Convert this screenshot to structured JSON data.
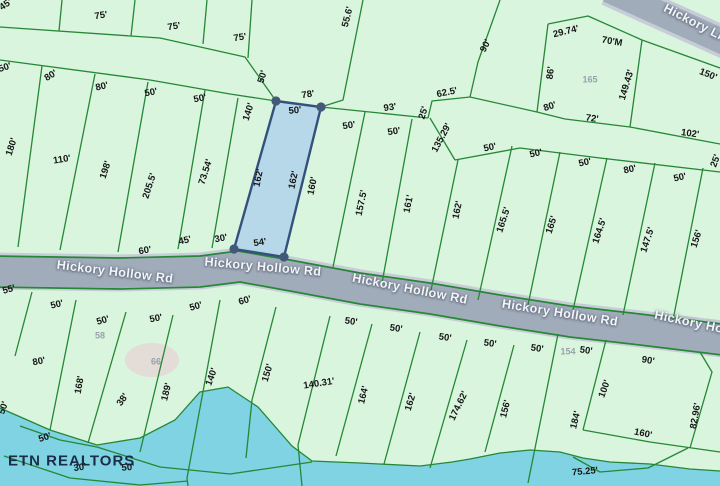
{
  "map": {
    "watermark": "ETN REALTORS",
    "roads": [
      "Hickory Hollow Rd",
      "Hickory Ln"
    ],
    "highlighted_parcel": {
      "fill": "#aed2ec",
      "border": "#33517c"
    },
    "colors": {
      "land": "#d9f5de",
      "lot_line": "#268736",
      "water": "#7fd3e2",
      "road_fill": "#a1acba",
      "road_casing": "#c7cdd7",
      "dimension_text": "#161616",
      "parcel_number_text": "#98a2ab",
      "road_text": "#f3f5f8",
      "watermark_text": "#13203d"
    },
    "labels": [
      {
        "t": "45'",
        "x": 6,
        "y": 5,
        "r": -35,
        "k": "dim"
      },
      {
        "t": "75'",
        "x": 101,
        "y": 16,
        "r": -9,
        "k": "dim"
      },
      {
        "t": "75'",
        "x": 174,
        "y": 27,
        "r": -9,
        "k": "dim"
      },
      {
        "t": "75'",
        "x": 240,
        "y": 38,
        "r": -9,
        "k": "dim"
      },
      {
        "t": "55.6'",
        "x": 348,
        "y": 17,
        "r": -76,
        "k": "dim"
      },
      {
        "t": "90'",
        "x": 486,
        "y": 46,
        "r": -62,
        "k": "dim"
      },
      {
        "t": "29.74'",
        "x": 566,
        "y": 32,
        "r": -14,
        "k": "dim"
      },
      {
        "t": "70'M",
        "x": 612,
        "y": 42,
        "r": 10,
        "k": "dim"
      },
      {
        "t": "86'",
        "x": 551,
        "y": 73,
        "r": -83,
        "k": "dim"
      },
      {
        "t": "165",
        "x": 590,
        "y": 80,
        "r": 0,
        "k": "num"
      },
      {
        "t": "149.43'",
        "x": 627,
        "y": 85,
        "r": -73,
        "k": "dim"
      },
      {
        "t": "150'",
        "x": 708,
        "y": 75,
        "r": 22,
        "k": "dim"
      },
      {
        "t": "80'",
        "x": 550,
        "y": 107,
        "r": -18,
        "k": "dim"
      },
      {
        "t": "72'",
        "x": 592,
        "y": 119,
        "r": 8,
        "k": "dim"
      },
      {
        "t": "102'",
        "x": 690,
        "y": 134,
        "r": 8,
        "k": "dim"
      },
      {
        "t": "25'",
        "x": 716,
        "y": 161,
        "r": -70,
        "k": "dim"
      },
      {
        "t": "50'",
        "x": 5,
        "y": 68,
        "r": -18,
        "k": "dim"
      },
      {
        "t": "80'",
        "x": 51,
        "y": 76,
        "r": -32,
        "k": "dim"
      },
      {
        "t": "80'",
        "x": 102,
        "y": 87,
        "r": -13,
        "k": "dim"
      },
      {
        "t": "50'",
        "x": 151,
        "y": 93,
        "r": -11,
        "k": "dim"
      },
      {
        "t": "50'",
        "x": 200,
        "y": 99,
        "r": -11,
        "k": "dim"
      },
      {
        "t": "50'",
        "x": 263,
        "y": 77,
        "r": -72,
        "k": "dim"
      },
      {
        "t": "140'",
        "x": 249,
        "y": 112,
        "r": -72,
        "k": "dim"
      },
      {
        "t": "78'",
        "x": 308,
        "y": 95,
        "r": -9,
        "k": "dim"
      },
      {
        "t": "50'",
        "x": 295,
        "y": 111,
        "r": -6,
        "k": "dim"
      },
      {
        "t": "93'",
        "x": 390,
        "y": 108,
        "r": -8,
        "k": "dim"
      },
      {
        "t": "62.5'",
        "x": 447,
        "y": 93,
        "r": -11,
        "k": "dim"
      },
      {
        "t": "25'",
        "x": 424,
        "y": 113,
        "r": -72,
        "k": "dim"
      },
      {
        "t": "135.29'",
        "x": 442,
        "y": 138,
        "r": -62,
        "k": "dim"
      },
      {
        "t": "50'",
        "x": 349,
        "y": 126,
        "r": -9,
        "k": "dim"
      },
      {
        "t": "50'",
        "x": 394,
        "y": 132,
        "r": -9,
        "k": "dim"
      },
      {
        "t": "50'",
        "x": 490,
        "y": 148,
        "r": -12,
        "k": "dim"
      },
      {
        "t": "50'",
        "x": 536,
        "y": 154,
        "r": -12,
        "k": "dim"
      },
      {
        "t": "50'",
        "x": 585,
        "y": 163,
        "r": -12,
        "k": "dim"
      },
      {
        "t": "80'",
        "x": 630,
        "y": 170,
        "r": -12,
        "k": "dim"
      },
      {
        "t": "50'",
        "x": 680,
        "y": 178,
        "r": -12,
        "k": "dim"
      },
      {
        "t": "180'",
        "x": 12,
        "y": 147,
        "r": -72,
        "k": "dim"
      },
      {
        "t": "110'",
        "x": 62,
        "y": 160,
        "r": -9,
        "k": "dim"
      },
      {
        "t": "198'",
        "x": 106,
        "y": 170,
        "r": -72,
        "k": "dim"
      },
      {
        "t": "205.5'",
        "x": 150,
        "y": 186,
        "r": -72,
        "k": "dim"
      },
      {
        "t": "73.54'",
        "x": 206,
        "y": 172,
        "r": -72,
        "k": "dim"
      },
      {
        "t": "162'",
        "x": 259,
        "y": 178,
        "r": -78,
        "k": "dim"
      },
      {
        "t": "162'",
        "x": 294,
        "y": 180,
        "r": -78,
        "k": "dim"
      },
      {
        "t": "160'",
        "x": 313,
        "y": 186,
        "r": -78,
        "k": "dim"
      },
      {
        "t": "157.5'",
        "x": 362,
        "y": 203,
        "r": -78,
        "k": "dim"
      },
      {
        "t": "161'",
        "x": 409,
        "y": 204,
        "r": -78,
        "k": "dim"
      },
      {
        "t": "162'",
        "x": 458,
        "y": 210,
        "r": -78,
        "k": "dim"
      },
      {
        "t": "165.5'",
        "x": 504,
        "y": 220,
        "r": -72,
        "k": "dim"
      },
      {
        "t": "165'",
        "x": 552,
        "y": 225,
        "r": -72,
        "k": "dim"
      },
      {
        "t": "164.5'",
        "x": 600,
        "y": 231,
        "r": -72,
        "k": "dim"
      },
      {
        "t": "147.5'",
        "x": 648,
        "y": 240,
        "r": -72,
        "k": "dim"
      },
      {
        "t": "156'",
        "x": 697,
        "y": 239,
        "r": -72,
        "k": "dim"
      },
      {
        "t": "60'",
        "x": 145,
        "y": 251,
        "r": -10,
        "k": "dim"
      },
      {
        "t": "45'",
        "x": 185,
        "y": 241,
        "r": -13,
        "k": "dim"
      },
      {
        "t": "30'",
        "x": 221,
        "y": 239,
        "r": -11,
        "k": "dim"
      },
      {
        "t": "54'",
        "x": 260,
        "y": 243,
        "r": -9,
        "k": "dim"
      },
      {
        "t": "Hickory Hollow Rd",
        "x": 115,
        "y": 272,
        "r": 7,
        "k": "road"
      },
      {
        "t": "Hickory Hollow Rd",
        "x": 263,
        "y": 267,
        "r": 5,
        "k": "road"
      },
      {
        "t": "Hickory Hollow Rd",
        "x": 410,
        "y": 289,
        "r": 11,
        "k": "road"
      },
      {
        "t": "Hickory Hollow Rd",
        "x": 560,
        "y": 313,
        "r": 9,
        "k": "road"
      },
      {
        "t": "Hickory Hollow Rd",
        "x": 712,
        "y": 327,
        "r": 12,
        "k": "road"
      },
      {
        "t": "Hickory Ln",
        "x": 695,
        "y": 23,
        "r": 27,
        "k": "road"
      },
      {
        "t": "55'",
        "x": 9,
        "y": 290,
        "r": -16,
        "k": "dim"
      },
      {
        "t": "50'",
        "x": 57,
        "y": 305,
        "r": -13,
        "k": "dim"
      },
      {
        "t": "50'",
        "x": 103,
        "y": 321,
        "r": -16,
        "k": "dim"
      },
      {
        "t": "50'",
        "x": 156,
        "y": 319,
        "r": -11,
        "k": "dim"
      },
      {
        "t": "50'",
        "x": 196,
        "y": 307,
        "r": -16,
        "k": "dim"
      },
      {
        "t": "60'",
        "x": 245,
        "y": 301,
        "r": -16,
        "k": "dim"
      },
      {
        "t": "50'",
        "x": 351,
        "y": 322,
        "r": 8,
        "k": "dim"
      },
      {
        "t": "50'",
        "x": 396,
        "y": 329,
        "r": 8,
        "k": "dim"
      },
      {
        "t": "50'",
        "x": 445,
        "y": 338,
        "r": 8,
        "k": "dim"
      },
      {
        "t": "50'",
        "x": 490,
        "y": 344,
        "r": 8,
        "k": "dim"
      },
      {
        "t": "50'",
        "x": 537,
        "y": 349,
        "r": 8,
        "k": "dim"
      },
      {
        "t": "154",
        "x": 568,
        "y": 352,
        "r": 0,
        "k": "num"
      },
      {
        "t": "50'",
        "x": 586,
        "y": 351,
        "r": 8,
        "k": "dim"
      },
      {
        "t": "90'",
        "x": 648,
        "y": 361,
        "r": 10,
        "k": "dim"
      },
      {
        "t": "58",
        "x": 100,
        "y": 336,
        "r": 0,
        "k": "num"
      },
      {
        "t": "66",
        "x": 156,
        "y": 362,
        "r": 0,
        "k": "num"
      },
      {
        "t": "80'",
        "x": 39,
        "y": 362,
        "r": -11,
        "k": "dim"
      },
      {
        "t": "168'",
        "x": 80,
        "y": 385,
        "r": -80,
        "k": "dim"
      },
      {
        "t": "38'",
        "x": 123,
        "y": 400,
        "r": -55,
        "k": "dim"
      },
      {
        "t": "189'",
        "x": 167,
        "y": 392,
        "r": -76,
        "k": "dim"
      },
      {
        "t": "140'",
        "x": 212,
        "y": 377,
        "r": -70,
        "k": "dim"
      },
      {
        "t": "150'",
        "x": 268,
        "y": 373,
        "r": -73,
        "k": "dim"
      },
      {
        "t": "140.31'",
        "x": 319,
        "y": 384,
        "r": -9,
        "k": "dim"
      },
      {
        "t": "164'",
        "x": 364,
        "y": 395,
        "r": -76,
        "k": "dim"
      },
      {
        "t": "162'",
        "x": 411,
        "y": 402,
        "r": -73,
        "k": "dim"
      },
      {
        "t": "174.62'",
        "x": 459,
        "y": 406,
        "r": -64,
        "k": "dim"
      },
      {
        "t": "156'",
        "x": 506,
        "y": 409,
        "r": -76,
        "k": "dim"
      },
      {
        "t": "184'",
        "x": 576,
        "y": 420,
        "r": -76,
        "k": "dim"
      },
      {
        "t": "100'",
        "x": 605,
        "y": 389,
        "r": -70,
        "k": "dim"
      },
      {
        "t": "160'",
        "x": 643,
        "y": 434,
        "r": 12,
        "k": "dim"
      },
      {
        "t": "82.96'",
        "x": 696,
        "y": 416,
        "r": -80,
        "k": "dim"
      },
      {
        "t": "50'",
        "x": 4,
        "y": 408,
        "r": -70,
        "k": "dim"
      },
      {
        "t": "50'",
        "x": 45,
        "y": 438,
        "r": -18,
        "k": "dim"
      },
      {
        "t": "30'",
        "x": 80,
        "y": 468,
        "r": -8,
        "k": "dim"
      },
      {
        "t": "50'",
        "x": 128,
        "y": 468,
        "r": -5,
        "k": "dim"
      },
      {
        "t": "75.25'",
        "x": 585,
        "y": 472,
        "r": -5,
        "k": "dim"
      },
      {
        "t": "ETN REALTORS",
        "x": 8,
        "y": 461,
        "r": 0,
        "k": "mark"
      }
    ]
  }
}
